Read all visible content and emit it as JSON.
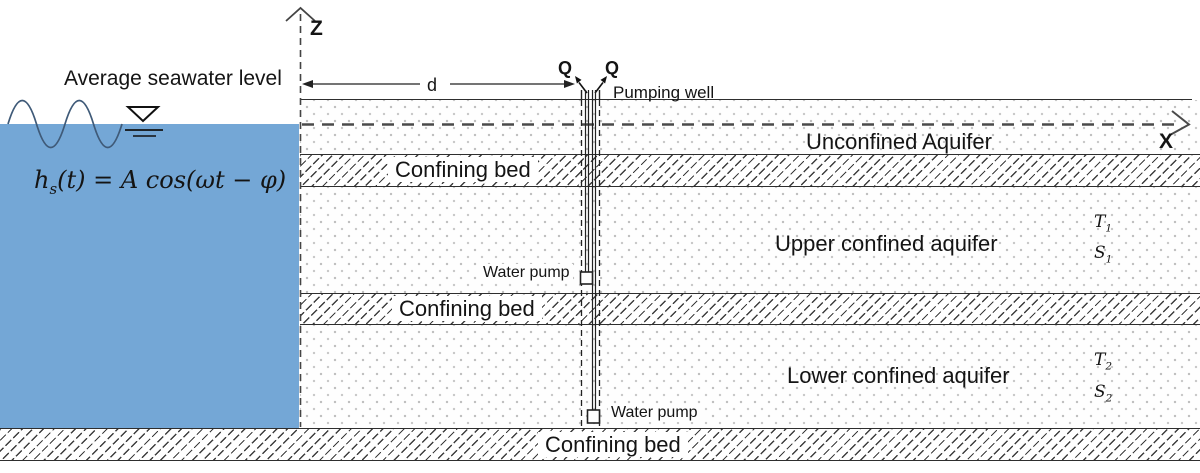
{
  "colors": {
    "sea": "#74a7d6",
    "line": "#2e2e2e",
    "hatch_line": "#3d3d3d",
    "dot": "#bdbdbd"
  },
  "sea": {
    "label": "Average seawater level",
    "equation": {
      "base": "h",
      "sub": "s",
      "rest": "(t) = A cos(ωt − φ)"
    }
  },
  "axes": {
    "z_label": "Z",
    "x_label": "X",
    "d_label": "d"
  },
  "well": {
    "q_label_left": "Q",
    "q_label_right": "Q",
    "pumping_well_label": "Pumping well",
    "upper_pump_label": "Water pump",
    "lower_pump_label": "Water pump"
  },
  "layers": {
    "unconfined_label": "Unconfined Aquifer",
    "bed1_label": "Confining bed",
    "upper_label": "Upper confined aquifer",
    "bed2_label": "Confining bed",
    "lower_label": "Lower confined aquifer",
    "bed3_label": "Confining bed",
    "t1": {
      "base": "T",
      "sub": "1"
    },
    "s1": {
      "base": "S",
      "sub": "1"
    },
    "t2": {
      "base": "T",
      "sub": "2"
    },
    "s2": {
      "base": "S",
      "sub": "2"
    }
  }
}
